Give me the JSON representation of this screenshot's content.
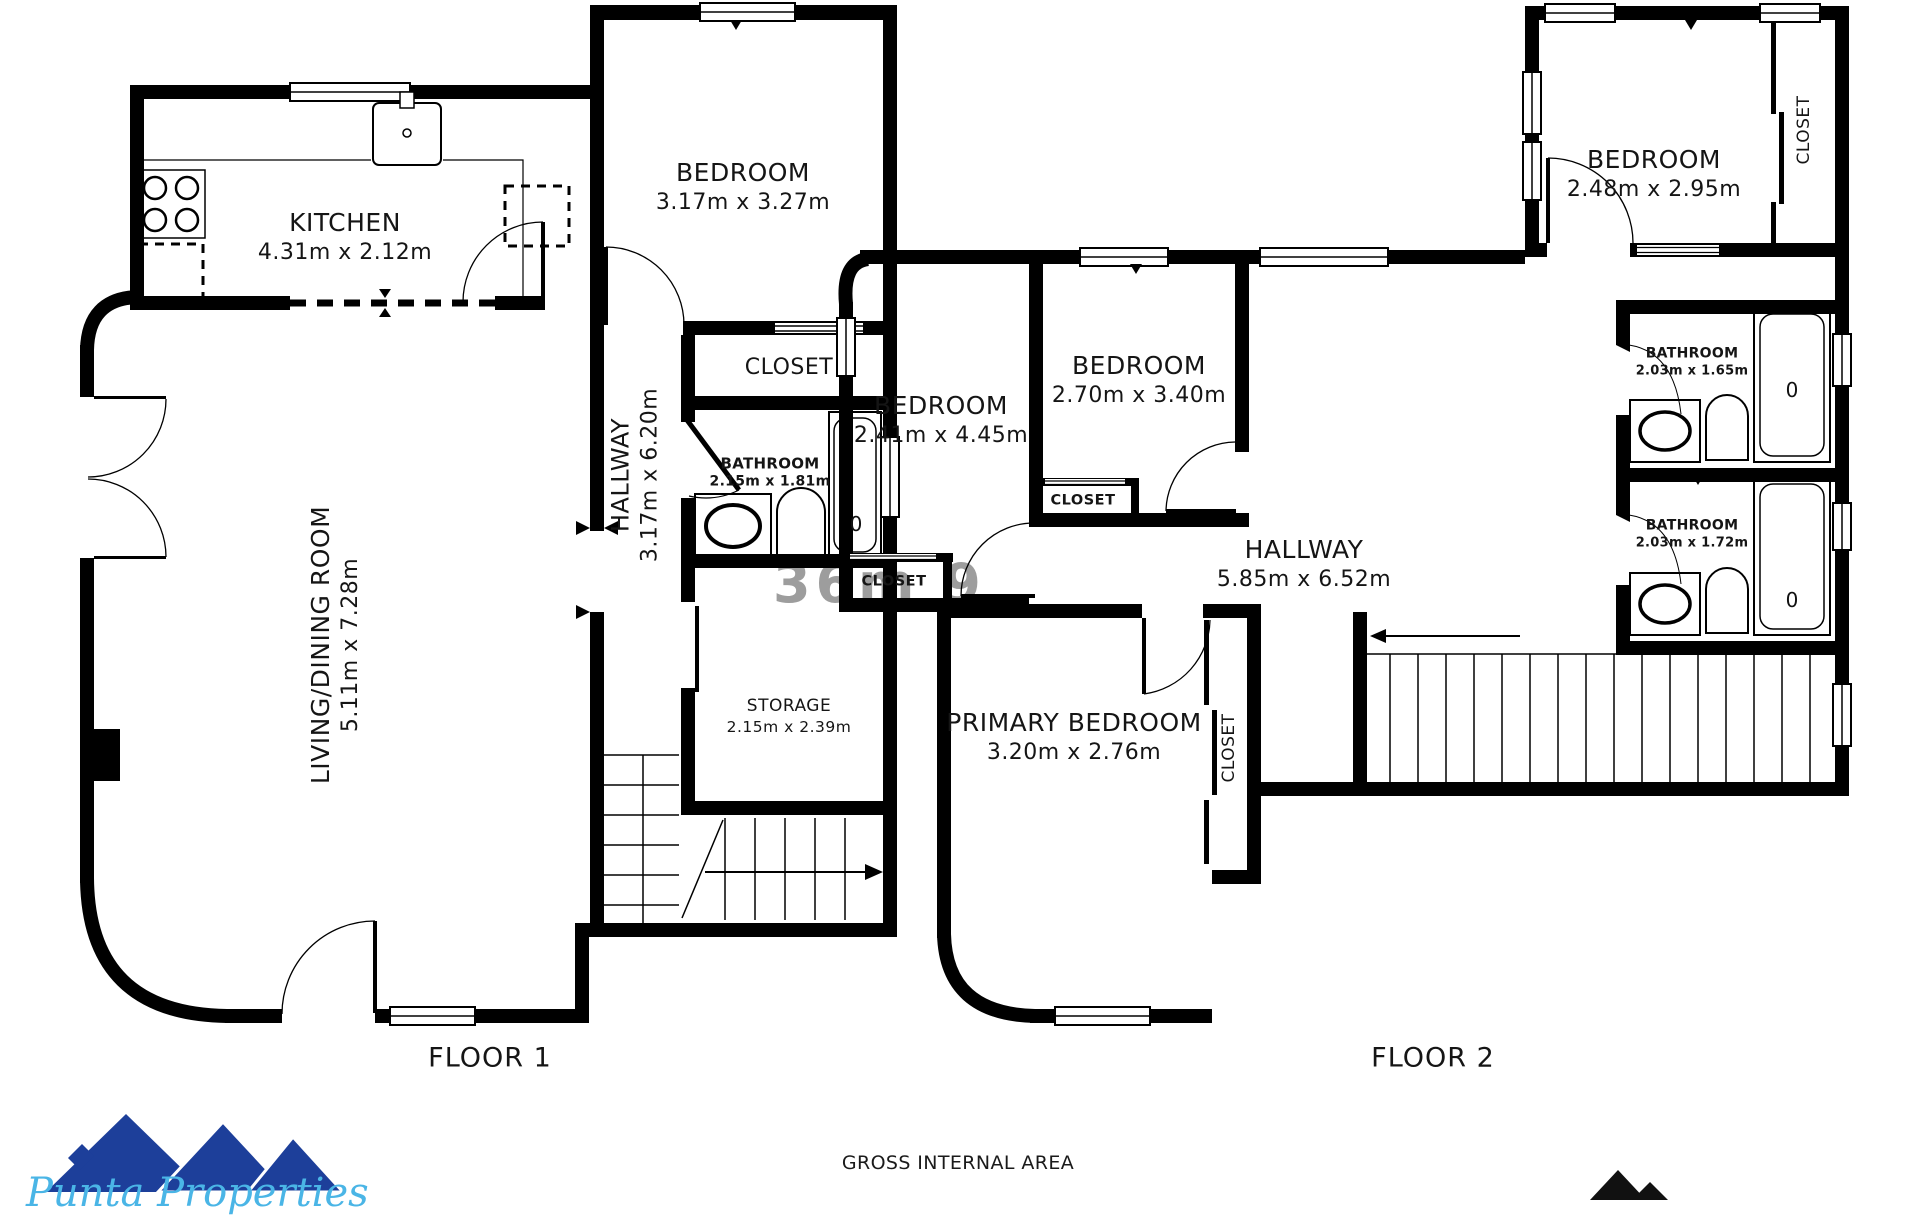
{
  "watermark": {
    "text": "36m 9"
  },
  "floor1": {
    "title": "FLOOR 1",
    "rooms": {
      "kitchen": {
        "name": "KITCHEN",
        "dims": "4.31m x 2.12m"
      },
      "bedroom": {
        "name": "BEDROOM",
        "dims": "3.17m x 3.27m"
      },
      "closet": {
        "name": "CLOSET"
      },
      "bathroom": {
        "name": "BATHROOM",
        "dims": "2.15m x 1.81m"
      },
      "hallway": {
        "name": "HALLWAY",
        "dims": "3.17m x 6.20m"
      },
      "living_dining": {
        "name": "LIVING/DINING ROOM",
        "dims": "5.11m x 7.28m"
      },
      "storage": {
        "name": "STORAGE",
        "dims": "2.15m x 2.39m"
      }
    },
    "fixtures": {
      "tub_mark": "0"
    }
  },
  "floor2": {
    "title": "FLOOR 2",
    "rooms": {
      "bedroom_top": {
        "name": "BEDROOM",
        "dims": "2.48m x 2.95m"
      },
      "closet_top": {
        "name": "CLOSET"
      },
      "bathroom_upper": {
        "name": "BATHROOM",
        "dims": "2.03m x 1.65m"
      },
      "bathroom_lower": {
        "name": "BATHROOM",
        "dims": "2.03m x 1.72m"
      },
      "bedroom_middle": {
        "name": "BEDROOM",
        "dims": "2.70m x 3.40m"
      },
      "bedroom_left": {
        "name": "BEDROOM",
        "dims": "2.41m x 4.45m"
      },
      "closet_middle": {
        "name": "CLOSET"
      },
      "closet_left": {
        "name": "CLOSET"
      },
      "hallway": {
        "name": "HALLWAY",
        "dims": "5.85m x 6.52m"
      },
      "primary_bedroom": {
        "name": "PRIMARY BEDROOM",
        "dims": "3.20m x 2.76m"
      },
      "closet_primary": {
        "name": "CLOSET"
      }
    },
    "fixtures": {
      "tub_mark_upper": "0",
      "tub_mark_lower": "0"
    }
  },
  "footer": {
    "gross_area_label": "GROSS INTERNAL AREA",
    "logo_text": "Punta Properties"
  },
  "colors": {
    "wall": "#000000",
    "logo_navy": "#1d3f9a",
    "logo_script": "#4ab5e6",
    "watermark": "#8c8c8c"
  }
}
